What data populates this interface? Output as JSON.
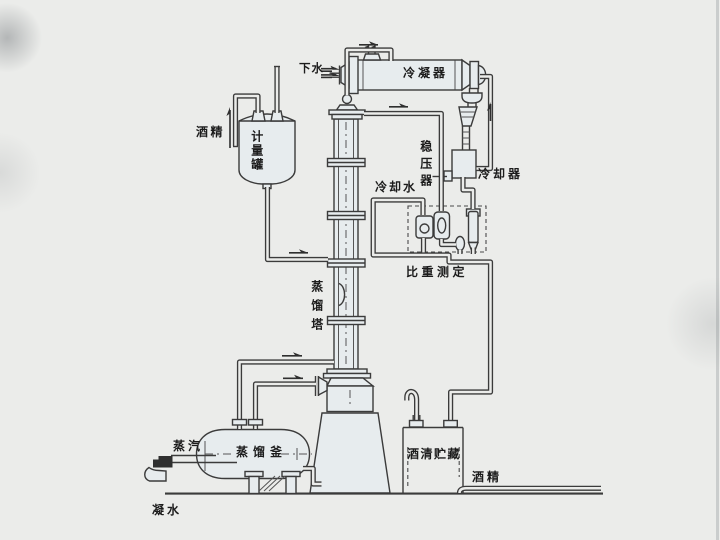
{
  "diagram_type": "process-flow-diagram",
  "labels": {
    "drain_water": "下水",
    "condenser": "冷凝器",
    "alcohol_feed": "酒精",
    "metering_tank": "计量罐",
    "stabilizer": "稳压器",
    "cooling_water": "冷却水",
    "cooler": "冷却器",
    "gravity_measurement": "比重测定",
    "distillation_tower": "蒸馏塔",
    "distillation_kettle": "蒸馏釜",
    "steam": "蒸汽",
    "alcohol_storage": "酒清贮藏",
    "alcohol_out": "酒精",
    "condensate": "凝水"
  },
  "colors": {
    "paper": "#ebecea",
    "line": "#3b3b3b",
    "vessel_fill": "#e7ecee",
    "text": "#1c1c1c"
  }
}
